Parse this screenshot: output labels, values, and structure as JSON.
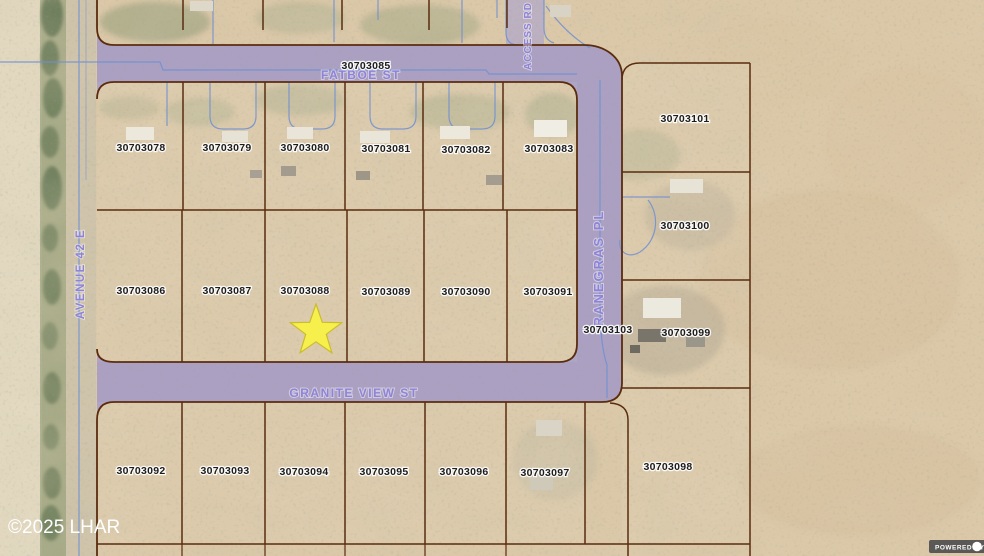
{
  "map": {
    "streets": {
      "top_street": "FATBOE ST",
      "bottom_street": "GRANITE VIEW ST",
      "east_street": "RANEGRAS PL",
      "west_avenue": "AVENUE 42 E",
      "access_road": "ACCESS RD"
    },
    "street_parcel_apn": "30703085",
    "parcel_rows": {
      "top": [
        "30703078",
        "30703079",
        "30703080",
        "30703081",
        "30703082",
        "30703083"
      ],
      "middle": [
        "30703086",
        "30703087",
        "30703088",
        "30703089",
        "30703090",
        "30703091"
      ],
      "bottom": [
        "30703092",
        "30703093",
        "30703094",
        "30703095",
        "30703096",
        "30703097"
      ]
    },
    "east_parcels": [
      "30703101",
      "30703100",
      "30703099",
      "30703098"
    ],
    "road_parcel_apn": "30703103",
    "marker": {
      "shape": "star",
      "on_parcel": "30703088",
      "fill": "#f7ef4b",
      "stroke": "#c9bd2c"
    },
    "colors": {
      "road_overlay": "#aba0c2",
      "parcel_boundary": "#5a2c0e",
      "street_label": "#8f83d8",
      "water_line": "#6f8fd2",
      "desert_base": "#dbc8a8"
    }
  },
  "footer": {
    "copyright": "©2025 LHAR",
    "powered_by": "POWERED BY"
  }
}
